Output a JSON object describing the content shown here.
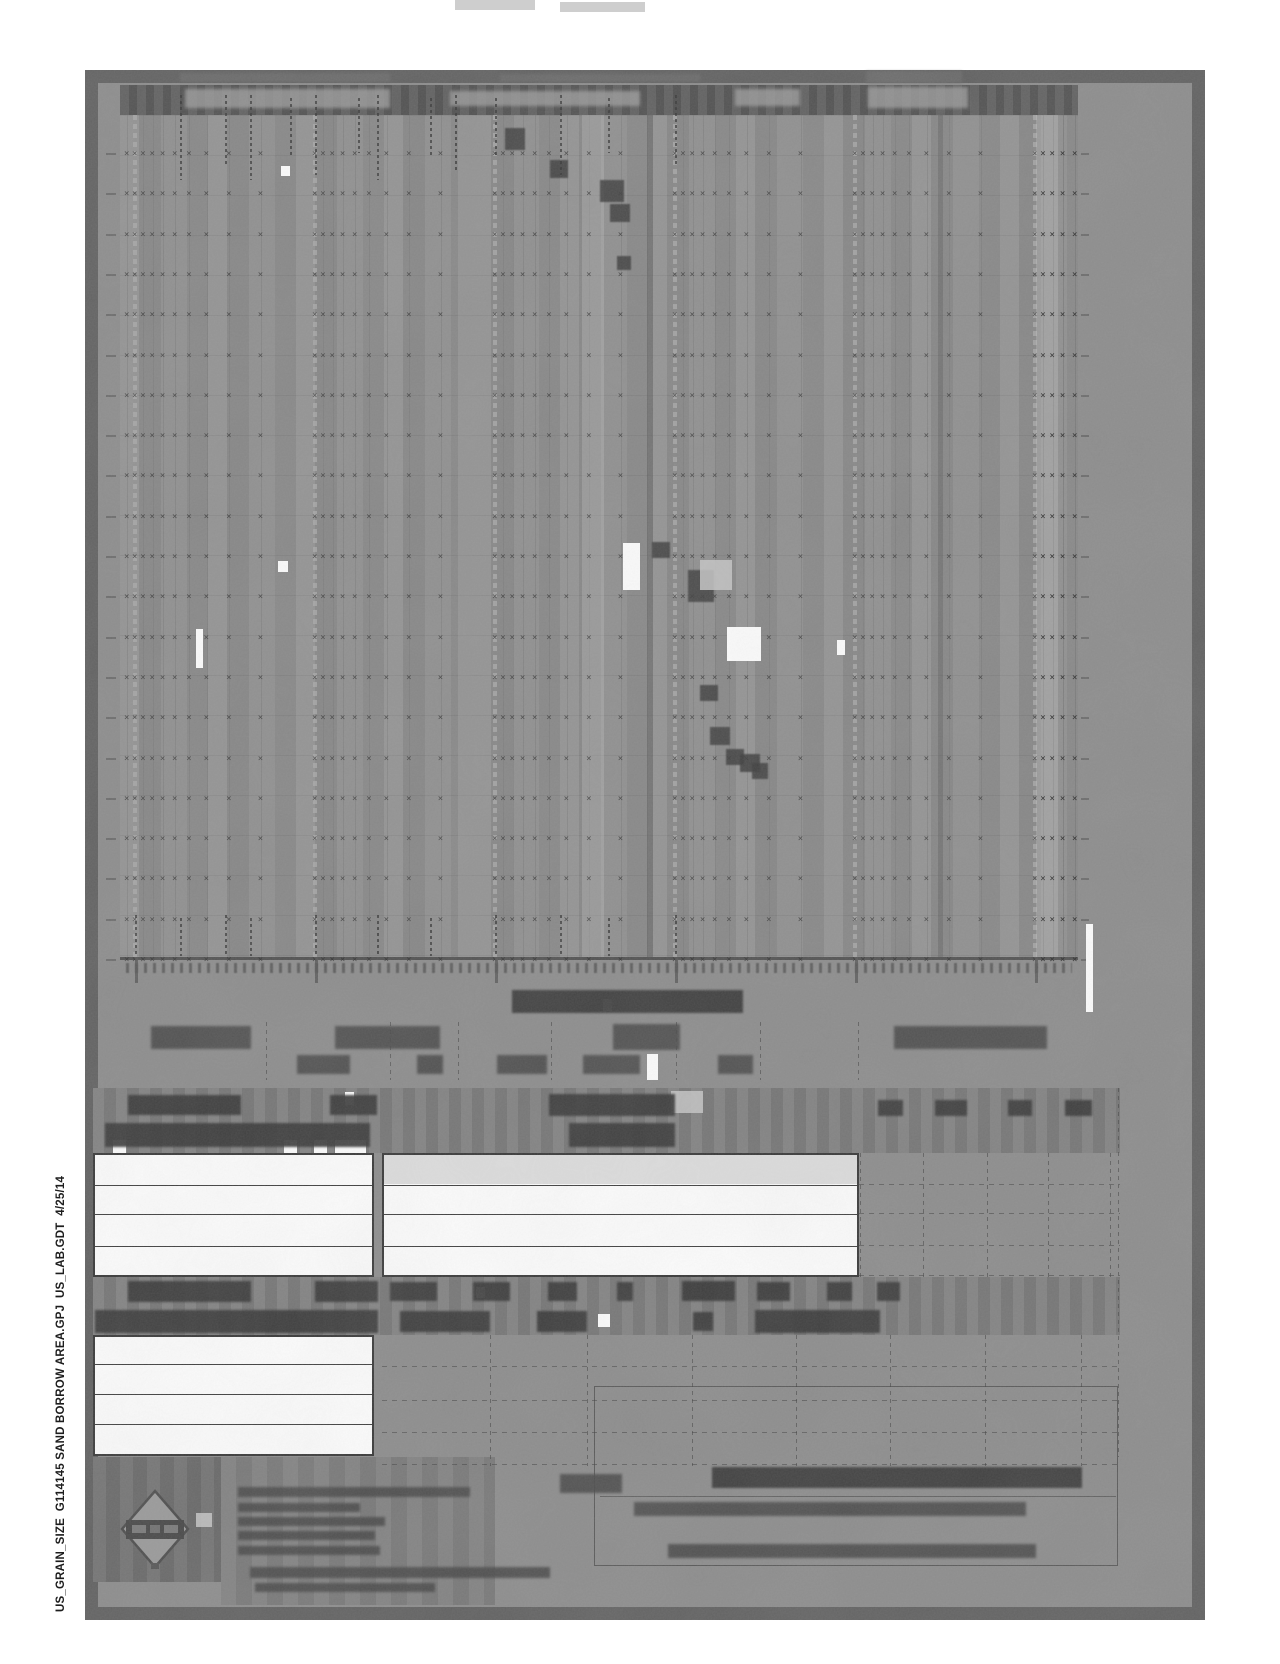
{
  "footer": {
    "vertical_text": "US_GRAIN_SIZE  G114145 SAND BORROW AREA.GPJ  US_LAB.GDT  4/25/14"
  },
  "colors": {
    "page": "#8c8c8c",
    "page_border": "#616161",
    "chart_header_band": "#565656",
    "table_band": "#7b7b7b",
    "smudge_dark": "#4a4a4a",
    "row_white": "#fcfcfc",
    "row_shaded": "#dcdcdc",
    "footer_text": "#1d1d1d"
  },
  "chart": {
    "symbol_glyph": "×",
    "left": 120,
    "top": 115,
    "width": 958,
    "height": 842,
    "major_gridlines_rel_x": [
      15,
      195,
      375,
      555,
      735,
      915
    ],
    "minor_offsets": [
      8.2,
      17.5,
      27.9,
      40,
      54.2,
      71.6,
      94.1,
      125.8
    ],
    "leading_minor_rel_x": [
      7
    ],
    "trailing_minor_rel_x": [
      923.2,
      932.5,
      942.9,
      955
    ],
    "symbol_rows": {
      "first_rel_y": 35,
      "step": 40.3,
      "count": 21
    },
    "tone_columns": [
      {
        "x": 462,
        "w": 22,
        "kind": "light",
        "opacity": 0.28
      },
      {
        "x": 916,
        "w": 22,
        "kind": "light",
        "opacity": 0.3
      },
      {
        "x": 338,
        "w": 14,
        "kind": "light",
        "opacity": 0.18
      },
      {
        "x": 527,
        "w": 6,
        "kind": "dark",
        "opacity": 0.45
      },
      {
        "x": 818,
        "w": 5,
        "kind": "dark",
        "opacity": 0.3
      }
    ],
    "curve_markers": [
      [
        505,
        128,
        20,
        22
      ],
      [
        550,
        160,
        18,
        18
      ],
      [
        600,
        180,
        24,
        22
      ],
      [
        610,
        204,
        20,
        18
      ],
      [
        617,
        256,
        14,
        14
      ],
      [
        652,
        542,
        18,
        16
      ],
      [
        688,
        570,
        26,
        32
      ],
      [
        700,
        685,
        18,
        16
      ],
      [
        710,
        727,
        20,
        18
      ],
      [
        726,
        749,
        18,
        16
      ],
      [
        740,
        754,
        20,
        18
      ],
      [
        752,
        763,
        16,
        16
      ]
    ]
  },
  "artifacts": {
    "white": [
      [
        281,
        166,
        9,
        10
      ],
      [
        278,
        561,
        10,
        11
      ],
      [
        623,
        543,
        17,
        47
      ],
      [
        727,
        627,
        34,
        34
      ],
      [
        196,
        629,
        7,
        39
      ],
      [
        837,
        640,
        8,
        15
      ],
      [
        1086,
        924,
        7,
        88
      ],
      [
        345,
        1092,
        9,
        13
      ],
      [
        647,
        1054,
        11,
        26
      ],
      [
        476,
        1287,
        9,
        11
      ],
      [
        603,
        999,
        9,
        12
      ],
      [
        113,
        1140,
        13,
        13
      ],
      [
        284,
        1140,
        13,
        13
      ],
      [
        314,
        1140,
        13,
        13
      ],
      [
        335,
        1140,
        31,
        13
      ],
      [
        598,
        1314,
        12,
        13
      ]
    ],
    "light": [
      [
        700,
        560,
        32,
        30
      ],
      [
        671,
        1091,
        32,
        22
      ],
      [
        196,
        1513,
        16,
        14
      ],
      [
        455,
        0,
        80,
        10
      ],
      [
        560,
        2,
        85,
        10
      ]
    ]
  },
  "smudges": {
    "above_header": [
      [
        180,
        73,
        210,
        9
      ],
      [
        500,
        74,
        200,
        8
      ],
      [
        866,
        71,
        96,
        12
      ]
    ],
    "header_ghost": [
      [
        185,
        89,
        205,
        19
      ],
      [
        450,
        91,
        190,
        15
      ],
      [
        735,
        89,
        65,
        17
      ],
      [
        868,
        87,
        100,
        21
      ]
    ],
    "axis_label": [
      [
        512,
        990,
        231,
        23
      ]
    ],
    "classification_labels": [
      [
        151,
        1026,
        100,
        23
      ],
      [
        335,
        1026,
        105,
        23
      ],
      [
        613,
        1024,
        67,
        26
      ],
      [
        894,
        1026,
        153,
        23
      ]
    ],
    "classification_sub": [
      [
        297,
        1055,
        53,
        19
      ],
      [
        417,
        1055,
        26,
        19
      ],
      [
        497,
        1055,
        50,
        19
      ],
      [
        583,
        1055,
        57,
        19
      ],
      [
        718,
        1055,
        35,
        19
      ]
    ],
    "table1_header_row1": [
      [
        128,
        1095,
        113,
        20
      ],
      [
        330,
        1095,
        47,
        20
      ],
      [
        549,
        1094,
        126,
        22
      ],
      [
        878,
        1100,
        25,
        16
      ],
      [
        935,
        1100,
        32,
        16
      ],
      [
        1008,
        1100,
        24,
        16
      ],
      [
        1065,
        1100,
        27,
        16
      ]
    ],
    "table1_header_row2": [
      [
        105,
        1123,
        265,
        24
      ],
      [
        569,
        1123,
        106,
        24
      ]
    ],
    "table2_header_row1": [
      [
        128,
        1281,
        123,
        21
      ],
      [
        315,
        1281,
        63,
        21
      ],
      [
        390,
        1282,
        47,
        19
      ],
      [
        473,
        1282,
        37,
        19
      ],
      [
        548,
        1282,
        29,
        19
      ],
      [
        617,
        1282,
        16,
        19
      ],
      [
        682,
        1281,
        53,
        20
      ],
      [
        757,
        1282,
        33,
        19
      ],
      [
        827,
        1282,
        25,
        19
      ],
      [
        877,
        1282,
        23,
        19
      ]
    ],
    "table2_header_row2": [
      [
        95,
        1310,
        283,
        23
      ],
      [
        400,
        1311,
        90,
        21
      ],
      [
        537,
        1311,
        50,
        21
      ],
      [
        693,
        1312,
        20,
        19
      ],
      [
        755,
        1310,
        125,
        23
      ]
    ],
    "company_lines": [
      [
        238,
        1487,
        232,
        10
      ],
      [
        238,
        1503,
        122,
        9
      ],
      [
        238,
        1517,
        147,
        9
      ],
      [
        238,
        1531,
        137,
        9
      ],
      [
        238,
        1546,
        142,
        9
      ],
      [
        250,
        1567,
        300,
        11
      ],
      [
        255,
        1583,
        180,
        9
      ]
    ],
    "title_heading": [
      [
        712,
        1467,
        370,
        21
      ]
    ],
    "title_lines": [
      [
        634,
        1502,
        392,
        14
      ],
      [
        668,
        1544,
        368,
        14
      ],
      [
        560,
        1474,
        62,
        19
      ]
    ]
  },
  "dotted_columns": {
    "top_sieve_labels": [
      [
        180,
        95,
        85
      ],
      [
        225,
        95,
        70
      ],
      [
        250,
        95,
        85
      ],
      [
        290,
        98,
        60
      ],
      [
        315,
        95,
        80
      ],
      [
        358,
        98,
        55
      ],
      [
        377,
        95,
        85
      ],
      [
        430,
        98,
        60
      ],
      [
        455,
        95,
        75
      ],
      [
        495,
        98,
        60
      ],
      [
        560,
        95,
        80
      ],
      [
        608,
        98,
        55
      ],
      [
        675,
        95,
        70
      ]
    ],
    "bottom_tick_labels": [
      [
        135,
        915,
        42
      ],
      [
        180,
        918,
        38
      ],
      [
        225,
        915,
        42
      ],
      [
        250,
        918,
        38
      ],
      [
        315,
        915,
        42
      ],
      [
        377,
        915,
        42
      ],
      [
        430,
        918,
        38
      ],
      [
        495,
        915,
        42
      ],
      [
        560,
        915,
        42
      ],
      [
        608,
        918,
        38
      ],
      [
        675,
        915,
        40
      ]
    ],
    "axis_stubs": [
      [
        135,
        957,
        26
      ],
      [
        315,
        957,
        26
      ],
      [
        495,
        957,
        26
      ],
      [
        675,
        957,
        26
      ],
      [
        855,
        957,
        26
      ],
      [
        1035,
        957,
        26
      ]
    ]
  },
  "classification_dividers_x": [
    266,
    390,
    458,
    551,
    676,
    760,
    858
  ],
  "table_grids": {
    "t1_vlines_x": [
      860,
      923,
      987,
      1048,
      1110
    ],
    "t1_vline_y": 1153,
    "t1_vline_h": 124,
    "t1_hlines_y": [
      1184,
      1213,
      1245,
      1275
    ],
    "t1_hline_x": 859,
    "t1_hline_w": 261,
    "t2_vlines_x": [
      490,
      587,
      692,
      796,
      890,
      985,
      1081
    ],
    "t2_vline_y": 1335,
    "t2_vline_h": 131,
    "t2_hlines_y": [
      1366,
      1400,
      1432,
      1464
    ],
    "t2_hline_x": 382,
    "t2_hline_w": 738
  },
  "logo": {
    "icon": "diamond-logo-icon"
  }
}
